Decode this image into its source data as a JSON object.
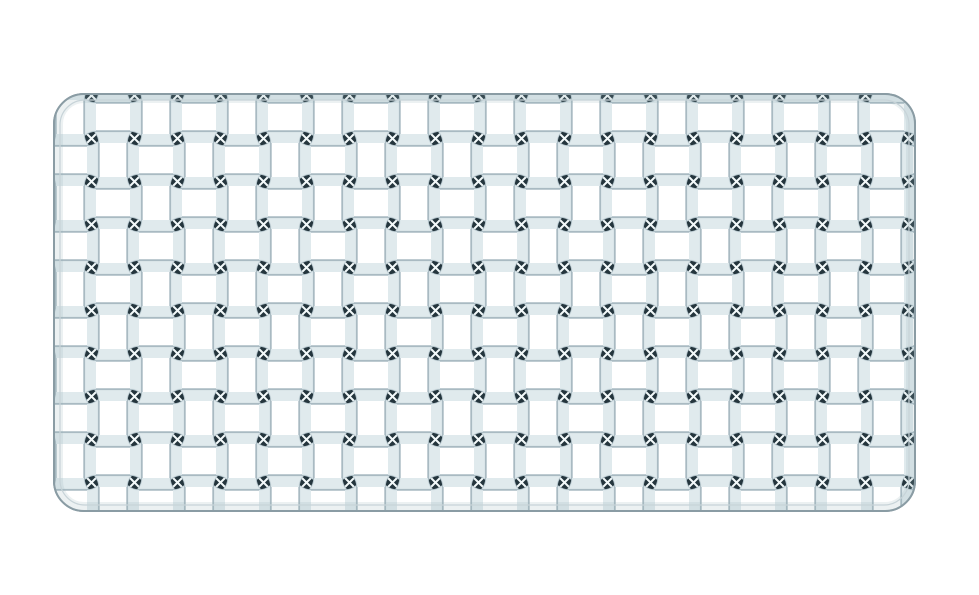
{
  "meta": {
    "subject": "Clear crystal rectangular platter with woven basketweave relief pattern, photographed flat on a plain white background",
    "background_color": "#ffffff"
  },
  "tray": {
    "x": 54,
    "y": 94,
    "width": 861,
    "height": 417,
    "corner_radius": 30,
    "fill_color": "#fdfeff",
    "outline_color": "#8a9ca4",
    "inner_line_color": "#c7d3d8",
    "inner_glow_color": "rgba(150,175,185,0.18)"
  },
  "pattern": {
    "cell_pitch": 43,
    "tile_size": 86,
    "bar_fill": "#ffffff",
    "bar_stroke": "#a9bac2",
    "bar_end_shade": "#dde8ec",
    "junction_fill": "#24353d",
    "junction_edge": "#64787f",
    "junction_highlight": "#f3f9fa"
  }
}
